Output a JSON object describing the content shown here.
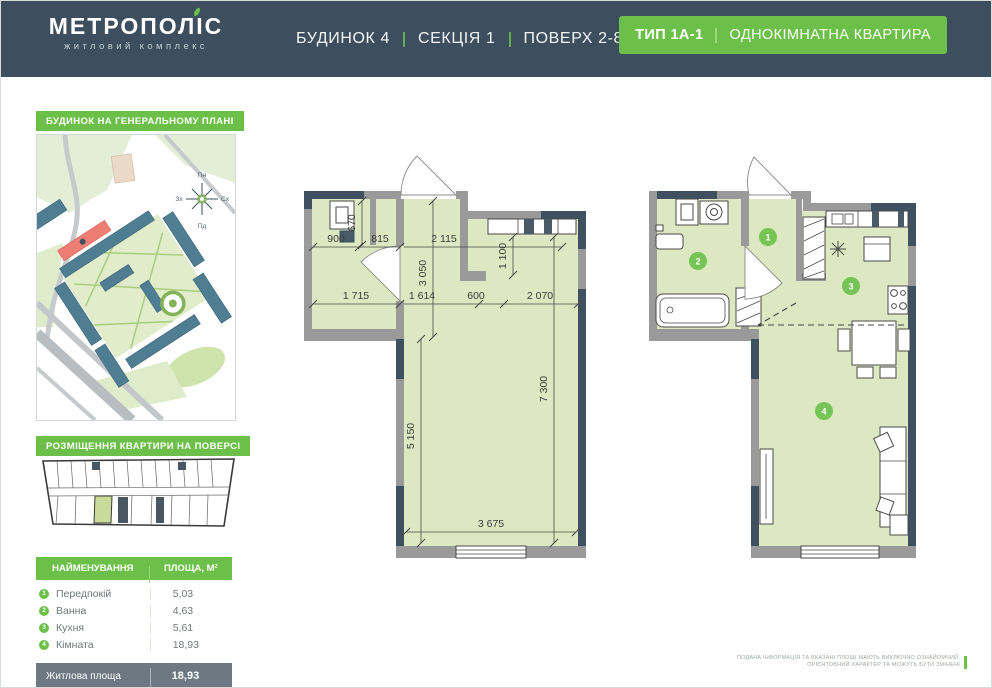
{
  "header": {
    "logo_title": "МЕТРОПОЛІС",
    "logo_subtitle": "житловий комплекс",
    "building": "БУДИНОК 4",
    "section": "СЕКЦІЯ 1",
    "floor": "ПОВЕРХ 2-8",
    "type_badge": {
      "type": "ТИП 1А-1",
      "description": "ОДНОКІМНАТНА КВАРТИРА"
    }
  },
  "sidebar": {
    "siteplan_label": "БУДИНОК НА ГЕНЕРАЛЬНОМУ ПЛАНІ",
    "floorplan_label": "РОЗМІЩЕННЯ КВАРТИРИ НА ПОВЕРСІ",
    "compass": {
      "north": "Пн",
      "south": "Пд",
      "east": "Сх",
      "west": "Зх"
    },
    "table": {
      "headers": [
        "НАЙМЕНУВАННЯ",
        "ПЛОЩА, М²"
      ],
      "rows": [
        {
          "num": "1",
          "name": "Передпокій",
          "area": "5,03"
        },
        {
          "num": "2",
          "name": "Ванна",
          "area": "4,63"
        },
        {
          "num": "3",
          "name": "Кухня",
          "area": "5,61"
        },
        {
          "num": "4",
          "name": "Кімната",
          "area": "18,93"
        }
      ],
      "summary": [
        {
          "label": "Житлова площа",
          "value": "18,93"
        },
        {
          "label": "Загальна площа",
          "value": "34,20"
        }
      ]
    }
  },
  "plan": {
    "rooms": [
      "1",
      "2",
      "3",
      "4"
    ],
    "dims": {
      "a900": "900",
      "a815": "815",
      "a670": "670",
      "a2115": "2 115",
      "a3050": "3 050",
      "a1100": "1 100",
      "a1715": "1 715",
      "a1614": "1 614",
      "a600": "600",
      "a2070": "2 070",
      "a5150": "5 150",
      "a7300": "7 300",
      "a3675": "3 675"
    }
  },
  "disclaimer": {
    "line1": "ПОДАНА ІНФОРМАЦІЯ ТА ВКАЗАНІ ПЛОЩІ МАЮТЬ ВИКЛЮЧНО ОЗНАЙОМЧИЙ,",
    "line2": "ОРІЄНТОВНИЙ ХАРАКТЕР ТА МОЖУТЬ БУТИ ЗМІНЕНІ"
  },
  "colors": {
    "accent_green": "#6cc04a",
    "header_dark": "#3d4f5e",
    "plan_fill": "#dde7c1",
    "wall_gray": "#9a9a9a",
    "wall_dark": "#3f5160",
    "table_footer": "#6d7883",
    "highlight_red": "#ee7e74",
    "unit_highlight": "#c9db9b"
  }
}
